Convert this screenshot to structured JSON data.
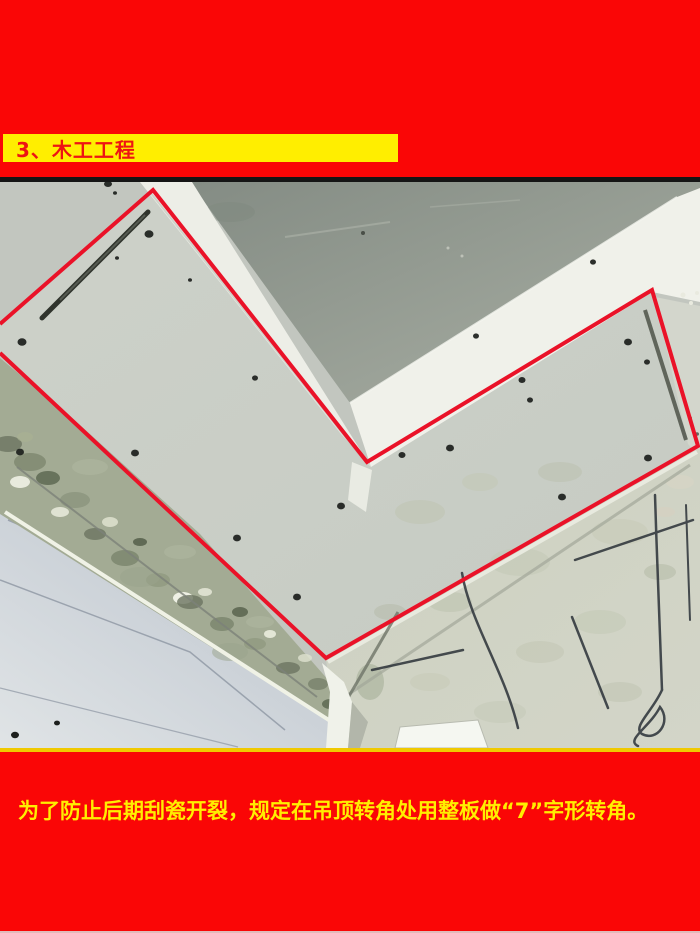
{
  "page": {
    "background_color": "#fa0606",
    "bottom_edge_line_color": "#dcdcdc"
  },
  "header": {
    "band_color": "#ffee00",
    "title": "3、木工工程",
    "title_color": "#ee1313"
  },
  "photo": {
    "alt": "吊顶转角处石膏板整板安装照片",
    "frame_top_color": "#151515",
    "frame_bottom_color": "#f0c900",
    "annotation": {
      "color": "#ea1228",
      "label": "7字形整板转角轮廓",
      "points": "0,142 153,8 367,280 652,108 698,264 326,476 0,171"
    }
  },
  "caption": {
    "text": "为了防止后期刮瓷开裂，规定在吊顶转角处用整板做“7”字形转角。",
    "color": "#ffee00"
  }
}
